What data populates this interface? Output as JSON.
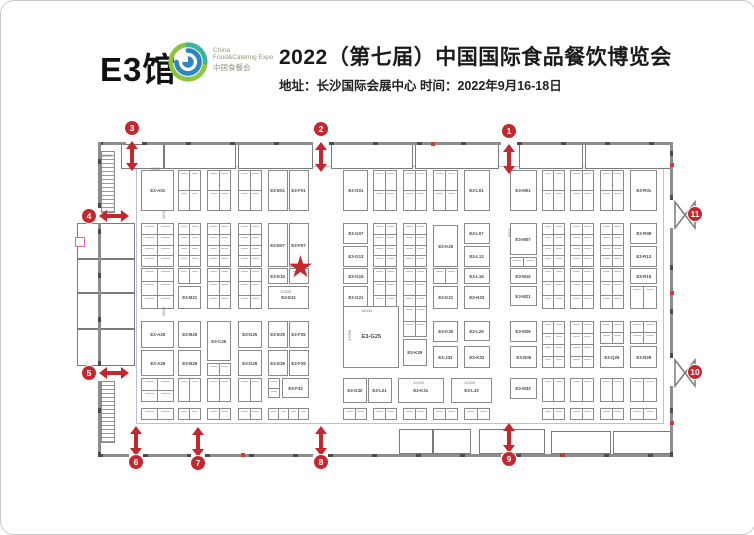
{
  "header": {
    "hall": "E3馆",
    "logo": {
      "line1": "China",
      "line2": "Food&Catering Expo",
      "line3": "中国食餐会"
    },
    "title": "2022（第七届）中国国际食品餐饮博览会",
    "subtitle": "地址：长沙国际会展中心  时间：2022年9月16-18日"
  },
  "icons": {
    "star": "★"
  },
  "colors": {
    "accent_red": "#c4272e",
    "wall_gray": "#6f6f6f",
    "booth_border": "#8a8a8a",
    "logo_green": "#8cc63f",
    "logo_blue": "#2e86c1"
  },
  "plan": {
    "field": {
      "x": 135,
      "y": 165,
      "w": 528,
      "h": 258
    },
    "walls": [
      {
        "x": 97,
        "y": 141,
        "w": 28,
        "h": 3
      },
      {
        "x": 141,
        "y": 141,
        "w": 171,
        "h": 3
      },
      {
        "x": 328,
        "y": 141,
        "w": 172,
        "h": 3
      },
      {
        "x": 516,
        "y": 141,
        "w": 156,
        "h": 3
      },
      {
        "x": 97,
        "y": 453,
        "w": 31,
        "h": 3
      },
      {
        "x": 142,
        "y": 453,
        "w": 48,
        "h": 3
      },
      {
        "x": 204,
        "y": 453,
        "w": 108,
        "h": 3
      },
      {
        "x": 327,
        "y": 453,
        "w": 173,
        "h": 3
      },
      {
        "x": 515,
        "y": 453,
        "w": 157,
        "h": 3
      },
      {
        "x": 97,
        "y": 141,
        "w": 3,
        "h": 66
      },
      {
        "x": 97,
        "y": 222,
        "w": 3,
        "h": 143
      },
      {
        "x": 97,
        "y": 380,
        "w": 3,
        "h": 76
      },
      {
        "x": 669,
        "y": 141,
        "w": 3,
        "h": 58
      },
      {
        "x": 669,
        "y": 227,
        "w": 3,
        "h": 130
      },
      {
        "x": 669,
        "y": 385,
        "w": 3,
        "h": 71
      }
    ],
    "rooms": [
      {
        "x": 120,
        "y": 143,
        "w": 43,
        "h": 25
      },
      {
        "x": 163,
        "y": 143,
        "w": 72,
        "h": 25
      },
      {
        "x": 237,
        "y": 143,
        "w": 75,
        "h": 25
      },
      {
        "x": 330,
        "y": 143,
        "w": 82,
        "h": 25
      },
      {
        "x": 414,
        "y": 143,
        "w": 84,
        "h": 25
      },
      {
        "x": 518,
        "y": 143,
        "w": 64,
        "h": 25
      },
      {
        "x": 584,
        "y": 143,
        "w": 86,
        "h": 25
      },
      {
        "x": 76,
        "y": 222,
        "w": 58,
        "h": 36
      },
      {
        "x": 76,
        "y": 258,
        "w": 58,
        "h": 34
      },
      {
        "x": 76,
        "y": 292,
        "w": 58,
        "h": 36
      },
      {
        "x": 76,
        "y": 328,
        "w": 58,
        "h": 37
      },
      {
        "x": 398,
        "y": 428,
        "w": 34,
        "h": 25
      },
      {
        "x": 432,
        "y": 428,
        "w": 38,
        "h": 25
      },
      {
        "x": 478,
        "y": 428,
        "w": 66,
        "h": 25
      },
      {
        "x": 550,
        "y": 430,
        "w": 60,
        "h": 23
      },
      {
        "x": 612,
        "y": 430,
        "w": 58,
        "h": 23
      }
    ],
    "stairs": [
      {
        "x": 100,
        "y": 150,
        "w": 14,
        "h": 62
      },
      {
        "x": 100,
        "y": 380,
        "w": 14,
        "h": 62
      }
    ],
    "booths": [
      {
        "label": "E3-A01",
        "x": 140,
        "y": 169,
        "w": 33,
        "h": 41
      },
      {
        "label": "E3-E01",
        "x": 267,
        "y": 169,
        "w": 20,
        "h": 41
      },
      {
        "label": "E3-F01",
        "x": 288,
        "y": 169,
        "w": 20,
        "h": 41
      },
      {
        "label": "E3-G01",
        "x": 342,
        "y": 169,
        "w": 25,
        "h": 41
      },
      {
        "label": "E3-L01",
        "x": 463,
        "y": 169,
        "w": 26,
        "h": 41
      },
      {
        "label": "E3-M01",
        "x": 509,
        "y": 169,
        "w": 27,
        "h": 41
      },
      {
        "label": "E3-R01",
        "x": 629,
        "y": 169,
        "w": 27,
        "h": 41
      },
      {
        "label": "E3-E07",
        "x": 267,
        "y": 222,
        "w": 20,
        "h": 44
      },
      {
        "label": "E3-F07",
        "x": 288,
        "y": 222,
        "w": 20,
        "h": 44
      },
      {
        "label": "E3-G07",
        "x": 342,
        "y": 222,
        "w": 25,
        "h": 21
      },
      {
        "label": "E3-G13",
        "x": 342,
        "y": 245,
        "w": 25,
        "h": 21
      },
      {
        "label": "E3-K26",
        "x": 432,
        "y": 224,
        "w": 25,
        "h": 42
      },
      {
        "label": "E3-L07",
        "x": 463,
        "y": 222,
        "w": 26,
        "h": 21
      },
      {
        "label": "E3-L13",
        "x": 463,
        "y": 245,
        "w": 26,
        "h": 21
      },
      {
        "label": "E3-M07",
        "x": 509,
        "y": 222,
        "w": 27,
        "h": 32
      },
      {
        "label": "E3-R08",
        "x": 629,
        "y": 222,
        "w": 27,
        "h": 21
      },
      {
        "label": "E3-R13",
        "x": 629,
        "y": 245,
        "w": 27,
        "h": 21
      },
      {
        "label": "E3-B21",
        "x": 177,
        "y": 285,
        "w": 23,
        "h": 23
      },
      {
        "label": "E3-E15",
        "x": 267,
        "y": 267,
        "w": 20,
        "h": 16
      },
      {
        "label": "E3-E21",
        "x": 267,
        "y": 285,
        "w": 41,
        "h": 23
      },
      {
        "label": "E3-G15",
        "x": 342,
        "y": 267,
        "w": 25,
        "h": 16
      },
      {
        "label": "E3-G21",
        "x": 342,
        "y": 285,
        "w": 25,
        "h": 23
      },
      {
        "label": "E3-K21",
        "x": 432,
        "y": 285,
        "w": 25,
        "h": 23
      },
      {
        "label": "E3-H33",
        "x": 463,
        "y": 285,
        "w": 26,
        "h": 23
      },
      {
        "label": "E3-L15",
        "x": 463,
        "y": 267,
        "w": 26,
        "h": 16
      },
      {
        "label": "E3-M15",
        "x": 509,
        "y": 267,
        "w": 27,
        "h": 16
      },
      {
        "label": "E3-M21",
        "x": 509,
        "y": 285,
        "w": 27,
        "h": 20
      },
      {
        "label": "E3-R15",
        "x": 629,
        "y": 267,
        "w": 27,
        "h": 16
      },
      {
        "label": "E3-A25",
        "x": 140,
        "y": 320,
        "w": 33,
        "h": 27
      },
      {
        "label": "E3-A29",
        "x": 140,
        "y": 349,
        "w": 33,
        "h": 26
      },
      {
        "label": "E3-B25",
        "x": 177,
        "y": 320,
        "w": 23,
        "h": 27
      },
      {
        "label": "E3-B29",
        "x": 177,
        "y": 349,
        "w": 23,
        "h": 26
      },
      {
        "label": "E3-C25",
        "x": 206,
        "y": 320,
        "w": 24,
        "h": 40
      },
      {
        "label": "E3-D25",
        "x": 237,
        "y": 320,
        "w": 24,
        "h": 27
      },
      {
        "label": "E3-D29",
        "x": 237,
        "y": 349,
        "w": 24,
        "h": 26
      },
      {
        "label": "E3-E25",
        "x": 267,
        "y": 320,
        "w": 20,
        "h": 27
      },
      {
        "label": "E3-F25",
        "x": 288,
        "y": 320,
        "w": 20,
        "h": 27
      },
      {
        "label": "E3-E29",
        "x": 267,
        "y": 349,
        "w": 20,
        "h": 26
      },
      {
        "label": "E3-F29",
        "x": 288,
        "y": 349,
        "w": 20,
        "h": 26
      },
      {
        "label": "E3-G25",
        "x": 342,
        "y": 305,
        "w": 56,
        "h": 62,
        "big": true
      },
      {
        "label": "E3-K29",
        "x": 402,
        "y": 338,
        "w": 24,
        "h": 27
      },
      {
        "label": "E3-K30",
        "x": 432,
        "y": 320,
        "w": 25,
        "h": 21
      },
      {
        "label": "E3-J33",
        "x": 432,
        "y": 345,
        "w": 25,
        "h": 22
      },
      {
        "label": "E3-L29",
        "x": 463,
        "y": 320,
        "w": 26,
        "h": 20
      },
      {
        "label": "E3-K33",
        "x": 463,
        "y": 345,
        "w": 26,
        "h": 22
      },
      {
        "label": "E3-M29",
        "x": 509,
        "y": 320,
        "w": 27,
        "h": 21
      },
      {
        "label": "E3-N05",
        "x": 509,
        "y": 345,
        "w": 27,
        "h": 22
      },
      {
        "label": "E3-Q29",
        "x": 599,
        "y": 345,
        "w": 24,
        "h": 22
      },
      {
        "label": "E3-R29",
        "x": 629,
        "y": 345,
        "w": 27,
        "h": 22
      },
      {
        "label": "E3-F33",
        "x": 281,
        "y": 377,
        "w": 27,
        "h": 20
      },
      {
        "label": "E3-G30",
        "x": 342,
        "y": 377,
        "w": 24,
        "h": 25
      },
      {
        "label": "E3-L21",
        "x": 367,
        "y": 377,
        "w": 24,
        "h": 25
      },
      {
        "label": "E3-K31",
        "x": 397,
        "y": 377,
        "w": 46,
        "h": 25
      },
      {
        "label": "E3-L33",
        "x": 450,
        "y": 377,
        "w": 41,
        "h": 25
      },
      {
        "label": "E3-M33",
        "x": 509,
        "y": 377,
        "w": 27,
        "h": 21
      }
    ],
    "cell_groups": [
      {
        "x": 177,
        "y": 169,
        "w": 23,
        "h": 41,
        "rows": 2,
        "cols": 2
      },
      {
        "x": 206,
        "y": 169,
        "w": 24,
        "h": 41,
        "rows": 2,
        "cols": 2
      },
      {
        "x": 237,
        "y": 169,
        "w": 24,
        "h": 41,
        "rows": 2,
        "cols": 2
      },
      {
        "x": 372,
        "y": 169,
        "w": 24,
        "h": 41,
        "rows": 2,
        "cols": 2
      },
      {
        "x": 402,
        "y": 169,
        "w": 24,
        "h": 41,
        "rows": 2,
        "cols": 2
      },
      {
        "x": 432,
        "y": 169,
        "w": 25,
        "h": 41,
        "rows": 2,
        "cols": 2
      },
      {
        "x": 541,
        "y": 169,
        "w": 23,
        "h": 41,
        "rows": 2,
        "cols": 2
      },
      {
        "x": 569,
        "y": 169,
        "w": 24,
        "h": 41,
        "rows": 2,
        "cols": 2
      },
      {
        "x": 599,
        "y": 169,
        "w": 24,
        "h": 41,
        "rows": 2,
        "cols": 2
      },
      {
        "x": 140,
        "y": 222,
        "w": 33,
        "h": 44,
        "rows": 4,
        "cols": 2
      },
      {
        "x": 177,
        "y": 222,
        "w": 23,
        "h": 44,
        "rows": 4,
        "cols": 2
      },
      {
        "x": 206,
        "y": 222,
        "w": 24,
        "h": 44,
        "rows": 4,
        "cols": 2
      },
      {
        "x": 237,
        "y": 222,
        "w": 24,
        "h": 44,
        "rows": 4,
        "cols": 2
      },
      {
        "x": 372,
        "y": 222,
        "w": 24,
        "h": 44,
        "rows": 4,
        "cols": 2
      },
      {
        "x": 402,
        "y": 222,
        "w": 24,
        "h": 44,
        "rows": 4,
        "cols": 2
      },
      {
        "x": 541,
        "y": 222,
        "w": 23,
        "h": 44,
        "rows": 4,
        "cols": 2
      },
      {
        "x": 569,
        "y": 222,
        "w": 24,
        "h": 44,
        "rows": 4,
        "cols": 2
      },
      {
        "x": 599,
        "y": 222,
        "w": 24,
        "h": 44,
        "rows": 4,
        "cols": 2
      },
      {
        "x": 509,
        "y": 256,
        "w": 27,
        "h": 10,
        "rows": 1,
        "cols": 2
      },
      {
        "x": 140,
        "y": 267,
        "w": 33,
        "h": 41,
        "rows": 3,
        "cols": 2
      },
      {
        "x": 177,
        "y": 267,
        "w": 23,
        "h": 16,
        "rows": 1,
        "cols": 2
      },
      {
        "x": 206,
        "y": 267,
        "w": 24,
        "h": 41,
        "rows": 3,
        "cols": 2
      },
      {
        "x": 237,
        "y": 267,
        "w": 24,
        "h": 41,
        "rows": 3,
        "cols": 2
      },
      {
        "x": 288,
        "y": 267,
        "w": 20,
        "h": 16,
        "rows": 1,
        "cols": 1
      },
      {
        "x": 372,
        "y": 267,
        "w": 24,
        "h": 41,
        "rows": 3,
        "cols": 2
      },
      {
        "x": 402,
        "y": 267,
        "w": 24,
        "h": 41,
        "rows": 3,
        "cols": 2
      },
      {
        "x": 432,
        "y": 267,
        "w": 25,
        "h": 16,
        "rows": 1,
        "cols": 2
      },
      {
        "x": 541,
        "y": 267,
        "w": 23,
        "h": 41,
        "rows": 3,
        "cols": 2
      },
      {
        "x": 569,
        "y": 267,
        "w": 24,
        "h": 41,
        "rows": 3,
        "cols": 2
      },
      {
        "x": 599,
        "y": 267,
        "w": 24,
        "h": 41,
        "rows": 3,
        "cols": 2
      },
      {
        "x": 629,
        "y": 285,
        "w": 27,
        "h": 23,
        "rows": 1,
        "cols": 2
      },
      {
        "x": 206,
        "y": 362,
        "w": 24,
        "h": 13,
        "rows": 1,
        "cols": 2
      },
      {
        "x": 402,
        "y": 305,
        "w": 24,
        "h": 31,
        "rows": 2,
        "cols": 2
      },
      {
        "x": 541,
        "y": 320,
        "w": 23,
        "h": 47,
        "rows": 4,
        "cols": 2
      },
      {
        "x": 569,
        "y": 320,
        "w": 24,
        "h": 47,
        "rows": 4,
        "cols": 2
      },
      {
        "x": 599,
        "y": 320,
        "w": 24,
        "h": 23,
        "rows": 2,
        "cols": 2
      },
      {
        "x": 629,
        "y": 320,
        "w": 27,
        "h": 23,
        "rows": 2,
        "cols": 2
      },
      {
        "x": 140,
        "y": 377,
        "w": 33,
        "h": 24,
        "rows": 2,
        "cols": 2
      },
      {
        "x": 177,
        "y": 377,
        "w": 23,
        "h": 24,
        "rows": 1,
        "cols": 2
      },
      {
        "x": 206,
        "y": 377,
        "w": 24,
        "h": 24,
        "rows": 1,
        "cols": 2
      },
      {
        "x": 237,
        "y": 377,
        "w": 24,
        "h": 24,
        "rows": 1,
        "cols": 2
      },
      {
        "x": 267,
        "y": 377,
        "w": 12,
        "h": 20,
        "rows": 2,
        "cols": 1
      },
      {
        "x": 541,
        "y": 377,
        "w": 23,
        "h": 24,
        "rows": 1,
        "cols": 2
      },
      {
        "x": 569,
        "y": 377,
        "w": 24,
        "h": 24,
        "rows": 1,
        "cols": 2
      },
      {
        "x": 599,
        "y": 377,
        "w": 24,
        "h": 24,
        "rows": 1,
        "cols": 2
      },
      {
        "x": 629,
        "y": 377,
        "w": 27,
        "h": 24,
        "rows": 1,
        "cols": 2
      },
      {
        "x": 140,
        "y": 407,
        "w": 33,
        "h": 12,
        "rows": 1,
        "cols": 2
      },
      {
        "x": 177,
        "y": 407,
        "w": 23,
        "h": 12,
        "rows": 1,
        "cols": 2
      },
      {
        "x": 206,
        "y": 407,
        "w": 24,
        "h": 12,
        "rows": 1,
        "cols": 2
      },
      {
        "x": 237,
        "y": 407,
        "w": 24,
        "h": 12,
        "rows": 1,
        "cols": 2
      },
      {
        "x": 267,
        "y": 407,
        "w": 41,
        "h": 12,
        "rows": 1,
        "cols": 4
      },
      {
        "x": 342,
        "y": 407,
        "w": 24,
        "h": 12,
        "rows": 1,
        "cols": 2
      },
      {
        "x": 372,
        "y": 407,
        "w": 24,
        "h": 12,
        "rows": 1,
        "cols": 2
      },
      {
        "x": 402,
        "y": 407,
        "w": 24,
        "h": 12,
        "rows": 1,
        "cols": 2
      },
      {
        "x": 432,
        "y": 407,
        "w": 25,
        "h": 12,
        "rows": 1,
        "cols": 2
      },
      {
        "x": 463,
        "y": 407,
        "w": 26,
        "h": 12,
        "rows": 1,
        "cols": 2
      },
      {
        "x": 541,
        "y": 407,
        "w": 23,
        "h": 12,
        "rows": 1,
        "cols": 2
      },
      {
        "x": 569,
        "y": 407,
        "w": 24,
        "h": 12,
        "rows": 1,
        "cols": 2
      },
      {
        "x": 599,
        "y": 407,
        "w": 24,
        "h": 12,
        "rows": 1,
        "cols": 2
      },
      {
        "x": 629,
        "y": 407,
        "w": 27,
        "h": 12,
        "rows": 1,
        "cols": 2
      }
    ],
    "dims": [
      {
        "t": "12500",
        "x": 100,
        "y": 152
      },
      {
        "t": "12000",
        "x": 279,
        "y": 288
      },
      {
        "t": "16000",
        "x": 360,
        "y": 307
      },
      {
        "t": "17000",
        "x": 346,
        "y": 340,
        "v": true
      },
      {
        "t": "12000",
        "x": 412,
        "y": 379
      },
      {
        "t": "12000",
        "x": 463,
        "y": 379
      },
      {
        "t": "4500",
        "x": 160,
        "y": 218,
        "v": true
      },
      {
        "t": "4500",
        "x": 160,
        "y": 315,
        "v": true
      },
      {
        "t": "9000",
        "x": 506,
        "y": 236,
        "v": true
      },
      {
        "t": "6000",
        "x": 150,
        "y": 165
      }
    ],
    "entrances": [
      {
        "n": "1",
        "bx": 508,
        "by": 130,
        "dir": "v",
        "ax": 508,
        "ay": 158
      },
      {
        "n": "2",
        "bx": 320,
        "by": 128,
        "dir": "v",
        "ax": 320,
        "ay": 156
      },
      {
        "n": "3",
        "bx": 131,
        "by": 127,
        "dir": "v",
        "ax": 131,
        "ay": 155
      },
      {
        "n": "4",
        "bx": 88,
        "by": 215,
        "dir": "h",
        "ax": 113,
        "ay": 215
      },
      {
        "n": "5",
        "bx": 88,
        "by": 372,
        "dir": "h",
        "ax": 113,
        "ay": 372
      },
      {
        "n": "6",
        "bx": 135,
        "by": 461,
        "dir": "v",
        "ax": 135,
        "ay": 440
      },
      {
        "n": "7",
        "bx": 197,
        "by": 462,
        "dir": "v",
        "ax": 197,
        "ay": 441
      },
      {
        "n": "8",
        "bx": 320,
        "by": 461,
        "dir": "v",
        "ax": 320,
        "ay": 440
      },
      {
        "n": "9",
        "bx": 508,
        "by": 458,
        "dir": "v",
        "ax": 508,
        "ay": 437
      },
      {
        "n": "10",
        "bx": 694,
        "by": 371,
        "dir": "none"
      },
      {
        "n": "11",
        "bx": 694,
        "by": 213,
        "dir": "none"
      }
    ],
    "doors": [
      {
        "x": 672,
        "y": 199
      },
      {
        "x": 672,
        "y": 357
      }
    ],
    "ticks": [
      {
        "x": 669,
        "y": 162
      },
      {
        "x": 669,
        "y": 290
      },
      {
        "x": 669,
        "y": 420
      },
      {
        "x": 240,
        "y": 452
      },
      {
        "x": 430,
        "y": 141
      },
      {
        "x": 560,
        "y": 452
      }
    ],
    "pink_marker": {
      "x": 74,
      "y": 236
    },
    "star": {
      "x": 286,
      "y": 252
    }
  }
}
